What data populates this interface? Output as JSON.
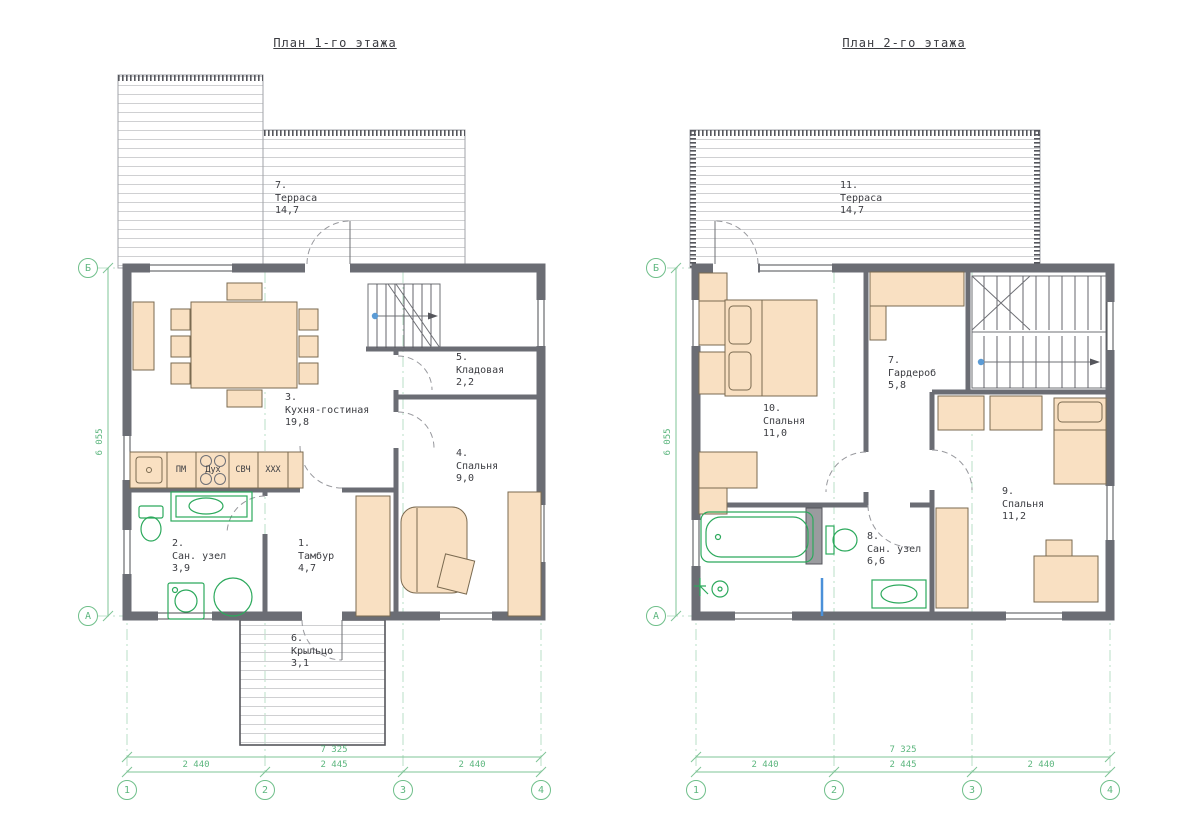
{
  "page": {
    "background": "#ffffff"
  },
  "colors": {
    "wall": "#6b6d74",
    "furniture_fill": "#f9e0c2",
    "plumbing_green": "#2ca95c",
    "dimension_green": "#5cb67e",
    "text": "#3b3c41",
    "hatch": "#cfd0d2",
    "accent_blue": "#5b9bd5"
  },
  "plan1": {
    "title": "План 1-го этажа",
    "rooms": {
      "hall": {
        "num": "1.",
        "name": "Тамбур",
        "area": "4,7"
      },
      "bathroom": {
        "num": "2.",
        "name": "Сан. узел",
        "area": "3,9"
      },
      "kitchen": {
        "num": "3.",
        "name": "Кухня-гостиная",
        "area": "19,8"
      },
      "bedroom": {
        "num": "4.",
        "name": "Спальня",
        "area": "9,0"
      },
      "storage": {
        "num": "5.",
        "name": "Кладовая",
        "area": "2,2"
      },
      "porch": {
        "num": "6.",
        "name": "Крыльцо",
        "area": "3,1"
      },
      "terrace": {
        "num": "7.",
        "name": "Терраса",
        "area": "14,7"
      }
    },
    "kitchen_units": {
      "dishwasher": "ПМ",
      "oven": "Дух",
      "microwave": "СВЧ",
      "fridge": "XXX"
    },
    "dimensions": {
      "total_width": "7 325",
      "span_12": "2 440",
      "span_23": "2 445",
      "span_34": "2 440",
      "height": "6 055"
    },
    "axes": {
      "v1": "1",
      "v2": "2",
      "v3": "3",
      "v4": "4",
      "hA": "А",
      "hB": "Б"
    }
  },
  "plan2": {
    "title": "План 2-го этажа",
    "rooms": {
      "wardrobe": {
        "num": "7.",
        "name": "Гардероб",
        "area": "5,8"
      },
      "bathroom": {
        "num": "8.",
        "name": "Сан. узел",
        "area": "6,6"
      },
      "bedroom9": {
        "num": "9.",
        "name": "Спальня",
        "area": "11,2"
      },
      "bedroom10": {
        "num": "10.",
        "name": "Спальня",
        "area": "11,0"
      },
      "terrace": {
        "num": "11.",
        "name": "Терраса",
        "area": "14,7"
      }
    },
    "dimensions": {
      "total_width": "7 325",
      "span_12": "2 440",
      "span_23": "2 445",
      "span_34": "2 440",
      "height": "6 055"
    },
    "axes": {
      "v1": "1",
      "v2": "2",
      "v3": "3",
      "v4": "4",
      "hA": "А",
      "hB": "Б"
    }
  }
}
